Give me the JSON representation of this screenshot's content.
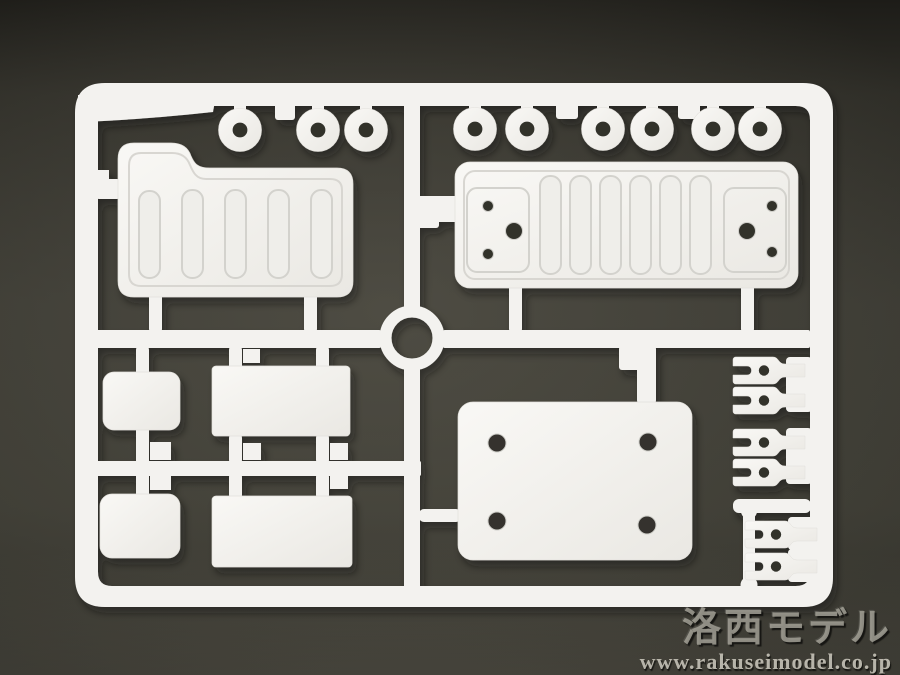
{
  "image_type": "photograph",
  "scene_description": "White injection-molded plastic model kit sprue (parts runner) lying on a dark gray surface",
  "watermark": {
    "brand": "洛西モデル",
    "url": "www.rakuseimodel.co.jp"
  },
  "colors": {
    "plastic": "#f3f2ef",
    "plastic_shade": "#e9e7e2",
    "groove_line": "#d3d2cd",
    "hole_dark": "#33322c",
    "background_mid": "#3a3932",
    "background_dark": "#1d1c18",
    "watermark_gray": "#9e9c92"
  },
  "sprue_contents": {
    "round_grommets_top_left_group": 3,
    "round_grommets_top_right_group": 6,
    "ribbed_cover_top_left": 1,
    "ribbed_long_plate_top_right": 1,
    "small_rounded_plates": 2,
    "small_rectangular_plates": 2,
    "four_hole_mounting_plate": 1,
    "fork_rod_ends_right_column": 6
  }
}
